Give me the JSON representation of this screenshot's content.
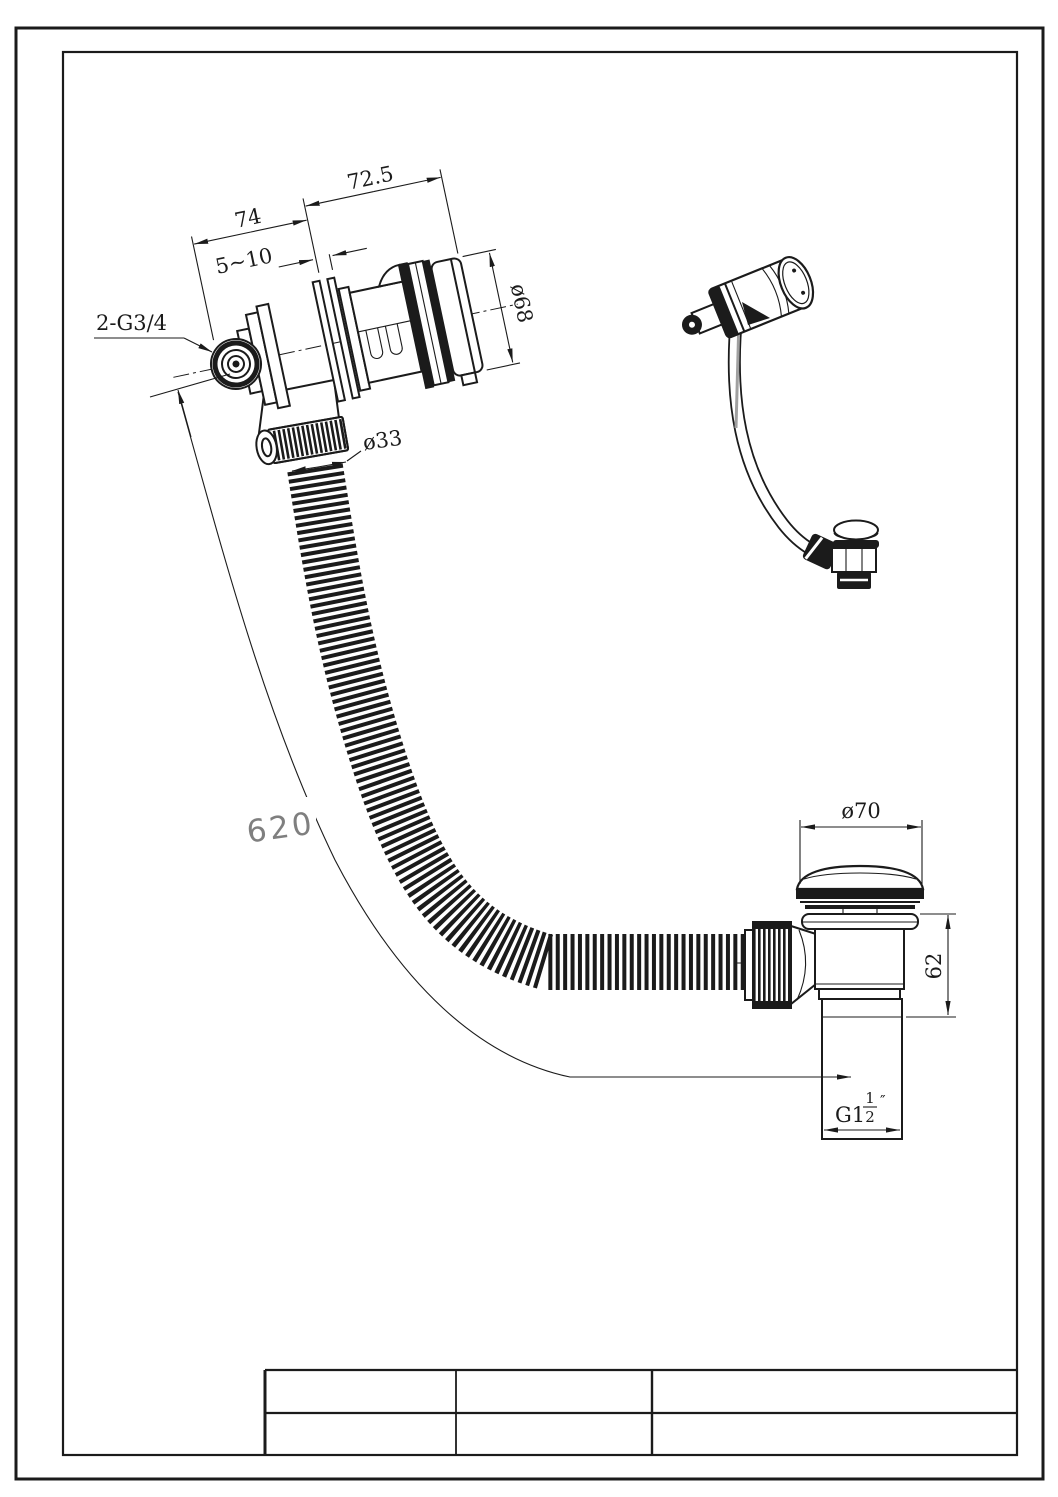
{
  "colors": {
    "line": "#1b1b1b",
    "dim_text": "#1b1b1b",
    "hose_length_text": "#7f7f7f",
    "background": "#ffffff"
  },
  "views": {
    "overflow_side_view": {
      "name": "bath overflow filler side section view",
      "dims": {
        "width_left": "74",
        "width_right": "72.5",
        "wall_gap": "5~10",
        "inlet_thread": "2-G3/4",
        "cap_diameter": "ø68",
        "hose_diameter": "ø33"
      }
    },
    "hose": {
      "length": "620"
    },
    "waste_side_view": {
      "name": "pop-up waste side view",
      "dims": {
        "cap_diameter": "ø70",
        "body_height": "62",
        "outlet_thread_prefix": "G1",
        "outlet_thread_numerator": "1",
        "outlet_thread_denominator": "2",
        "outlet_thread_unit": "″"
      }
    },
    "isometric_view": {
      "name": "assembly isometric view"
    },
    "title_block": {
      "rows": 2,
      "columns": 3,
      "cells": [
        [
          "",
          "",
          ""
        ],
        [
          "",
          "",
          ""
        ]
      ]
    }
  }
}
